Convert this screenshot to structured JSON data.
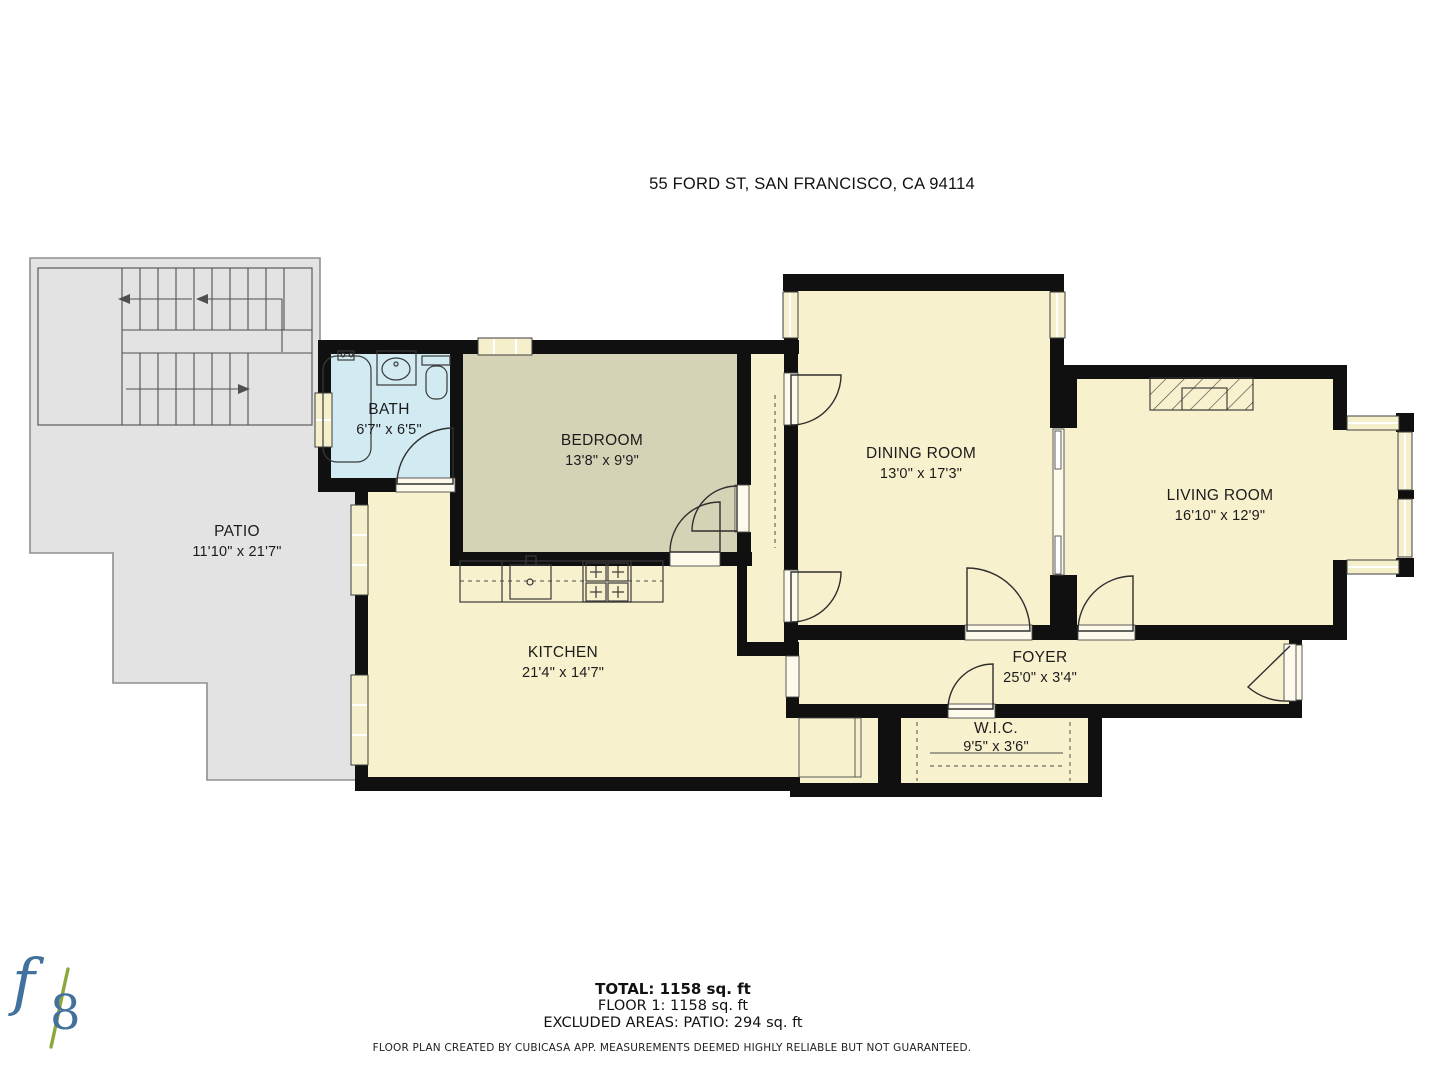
{
  "title": "55 FORD ST, SAN FRANCISCO, CA 94114",
  "rooms": [
    {
      "id": "patio",
      "name": "PATIO",
      "dims": "11'10\" x 21'7\""
    },
    {
      "id": "bath",
      "name": "BATH",
      "dims": "6'7\" x 6'5\""
    },
    {
      "id": "bedroom",
      "name": "BEDROOM",
      "dims": "13'8\" x 9'9\""
    },
    {
      "id": "dining-room",
      "name": "DINING ROOM",
      "dims": "13'0\" x 17'3\""
    },
    {
      "id": "living-room",
      "name": "LIVING ROOM",
      "dims": "16'10\" x 12'9\""
    },
    {
      "id": "kitchen",
      "name": "KITCHEN",
      "dims": "21'4\" x 14'7\""
    },
    {
      "id": "foyer",
      "name": "FOYER",
      "dims": "25'0\" x 3'4\""
    },
    {
      "id": "wic",
      "name": "W.I.C.",
      "dims": "9'5\" x 3'6\""
    }
  ],
  "summary": {
    "total": "TOTAL: 1158 sq. ft",
    "floor": "FLOOR 1: 1158 sq. ft",
    "excluded": "EXCLUDED AREAS: PATIO: 294 sq. ft"
  },
  "disclaimer": "FLOOR PLAN CREATED BY CUBICASA APP. MEASUREMENTS DEEMED HIGHLY RELIABLE BUT NOT GUARANTEED.",
  "logo": {
    "f": "f",
    "eight": "8"
  },
  "colors": {
    "wall-color": "#101010",
    "room-fill": "#f8f1cd",
    "bedroom-fill": "#d5d3b6",
    "bath-fill": "#d2eaf2",
    "patio-fill": "#e3e3e3",
    "logo-blue": "#41719c",
    "logo-green": "#8ca83d"
  }
}
